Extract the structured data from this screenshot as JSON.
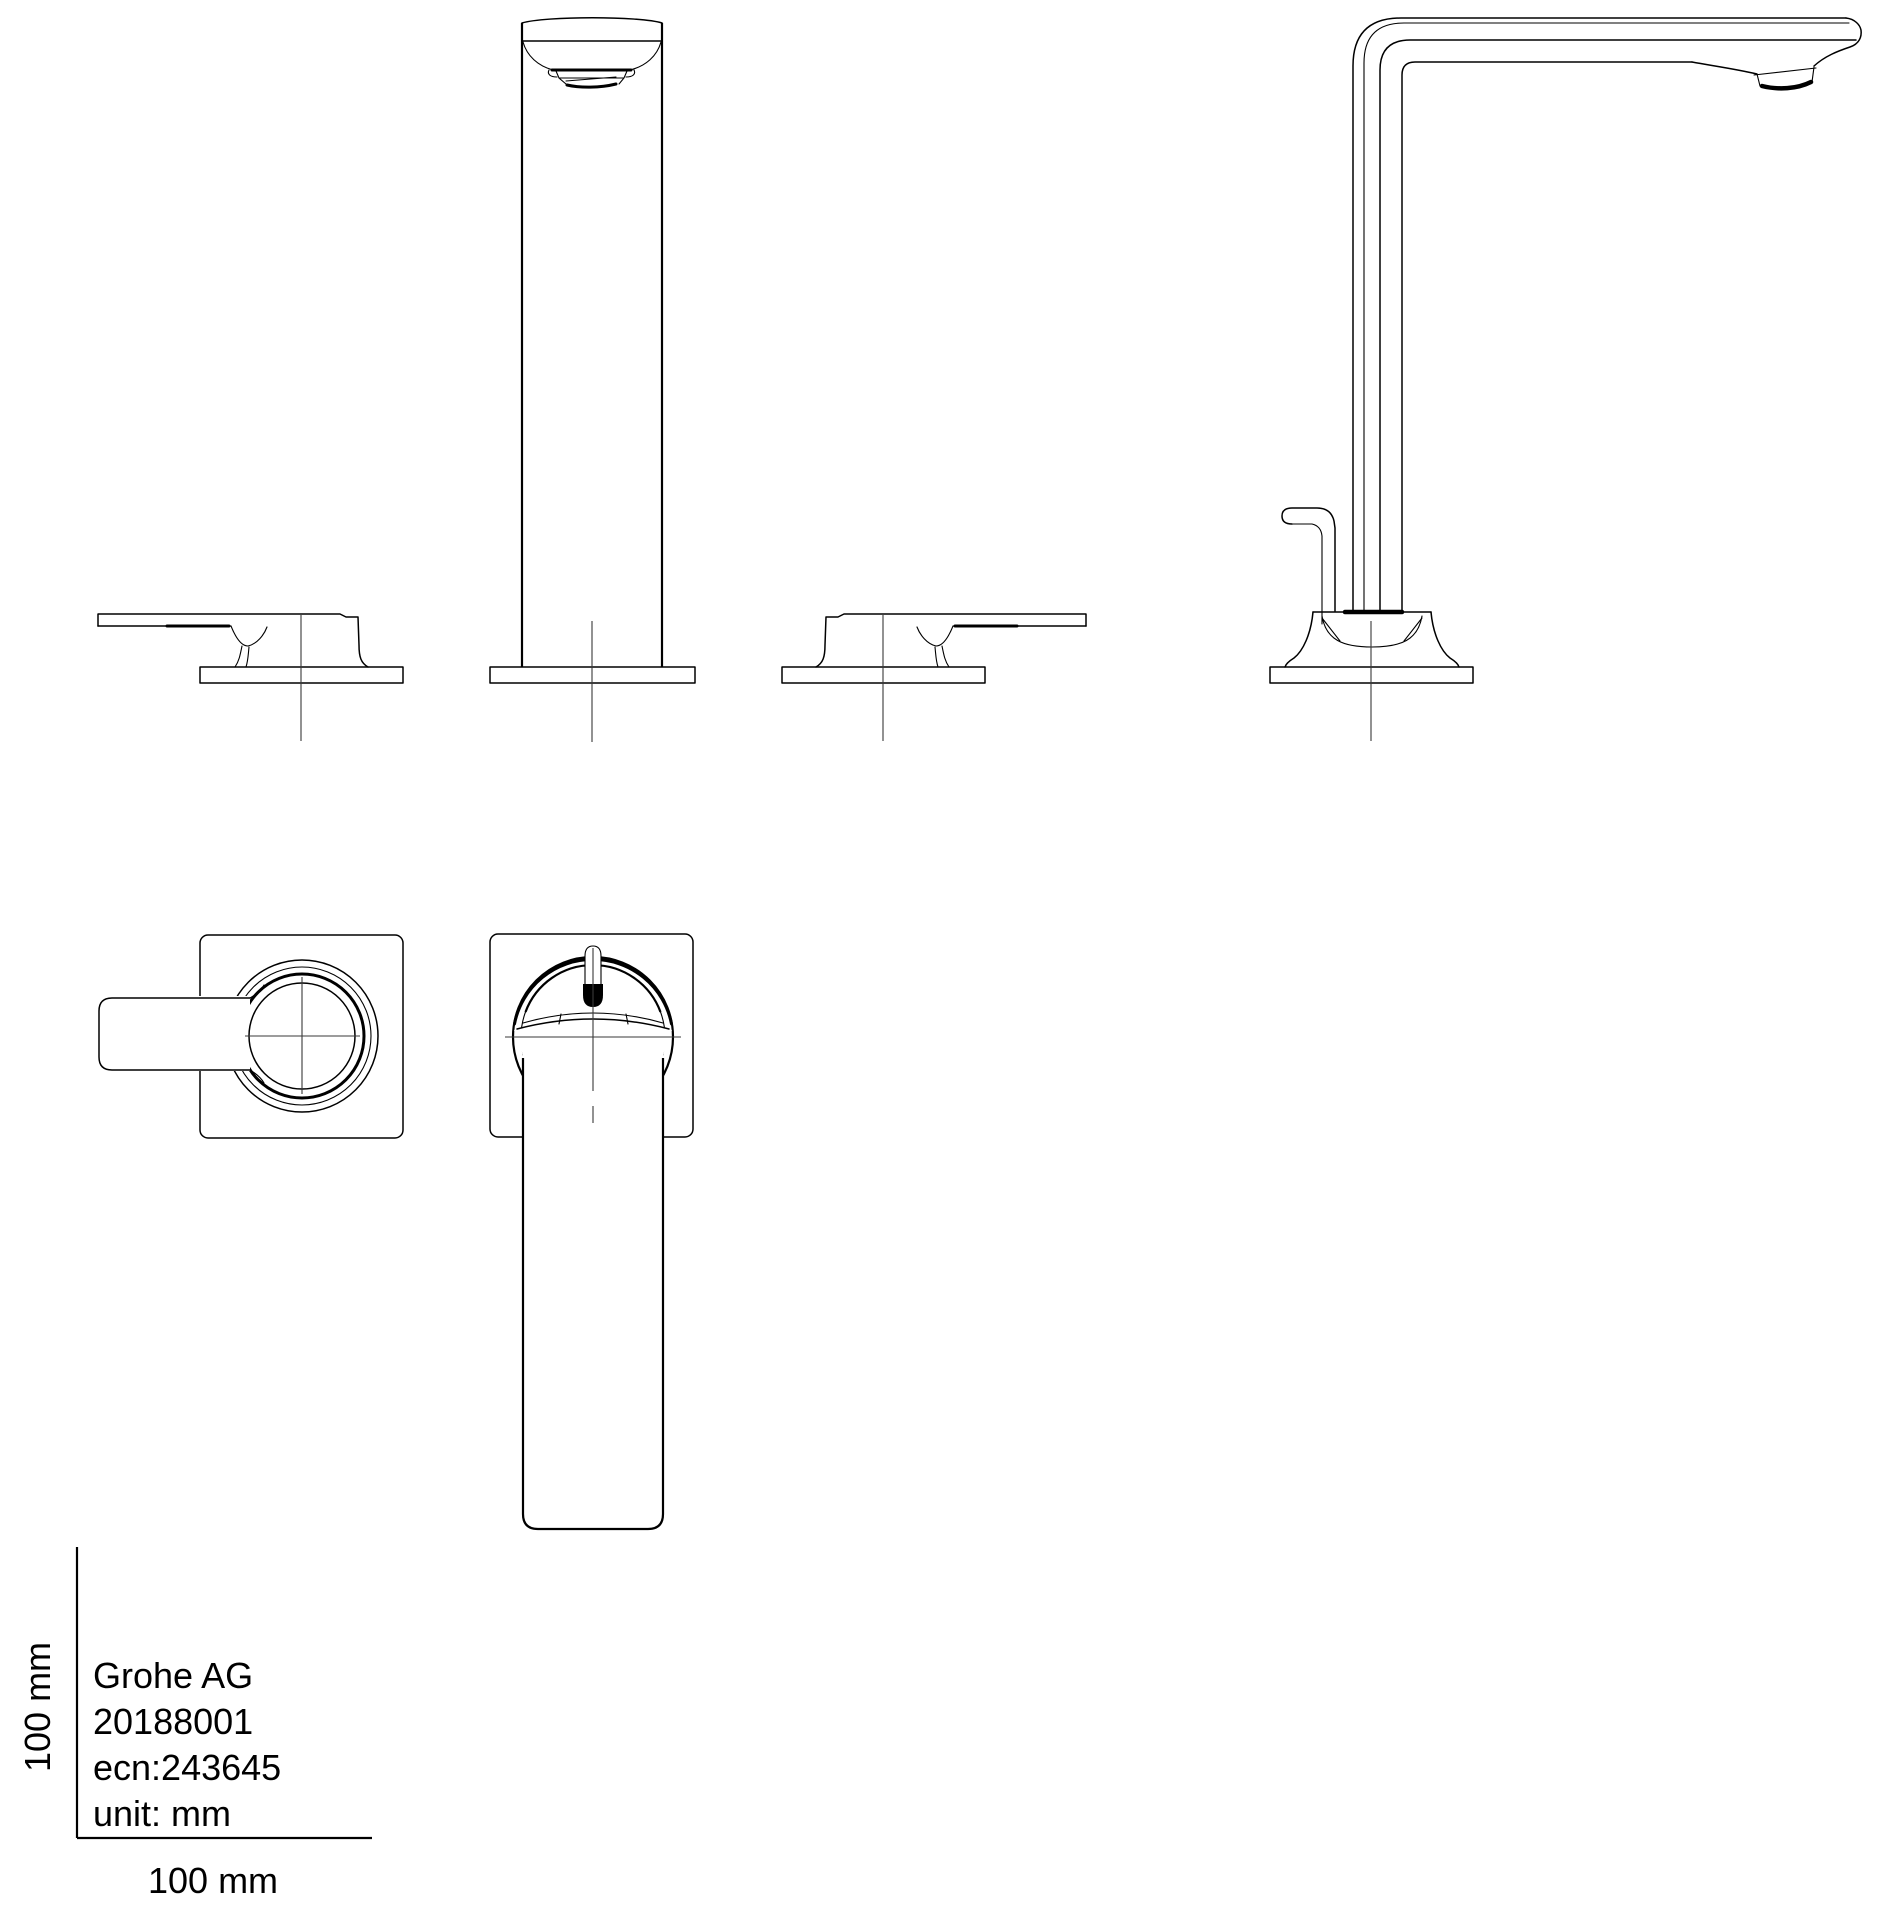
{
  "title_block": {
    "line1": "Grohe AG",
    "line2": "20188001",
    "line3": "ecn:243645",
    "line4": "unit: mm"
  },
  "scale_ruler": {
    "vertical_label": "100 mm",
    "horizontal_label": "100 mm"
  },
  "colors": {
    "line": "#000000",
    "centerline": "#3a3a3a",
    "background": "#ffffff"
  }
}
